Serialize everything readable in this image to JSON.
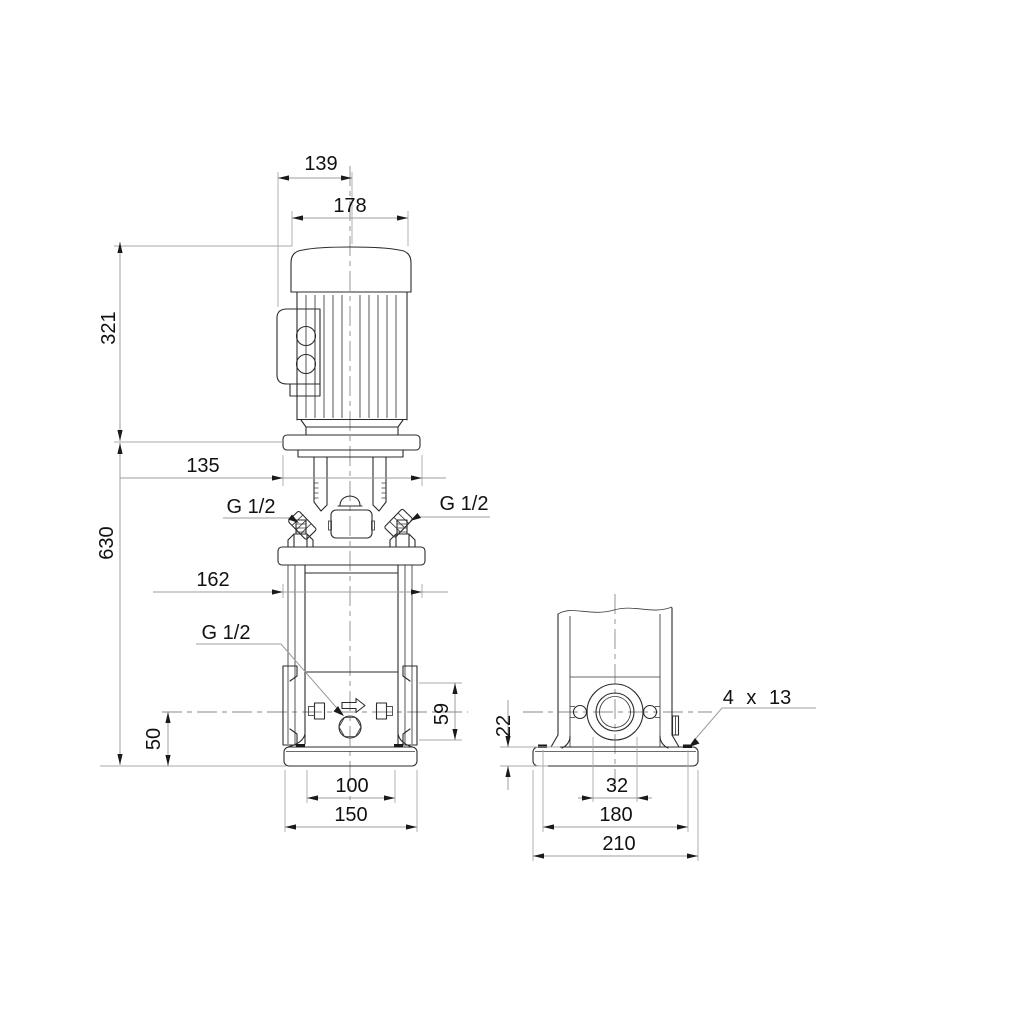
{
  "drawing": {
    "type": "technical-dimensional-drawing",
    "subject": "Vertical multistage centrifugal pump outline dimensions, side view and end view",
    "background_color": "#ffffff",
    "colors": {
      "object_line": "#2b2b2b",
      "dimension_line": "#9c9c9c",
      "text": "#111111"
    },
    "views": {
      "side": {
        "d139": "139",
        "d178": "178",
        "d321": "321",
        "d630": "630",
        "d135": "135",
        "d162": "162",
        "g12_left": "G 1/2",
        "g12_right": "G 1/2",
        "g12_drain": "G 1/2",
        "d50": "50",
        "d59": "59",
        "d100": "100",
        "d150": "150"
      },
      "end": {
        "d22": "22",
        "d32": "32",
        "d180": "180",
        "d210": "210",
        "bolt_holes": "4 x 13"
      }
    },
    "icons": {
      "flow_direction": "flow-arrow-icon",
      "drain_plug": "hex-plug-icon"
    }
  }
}
